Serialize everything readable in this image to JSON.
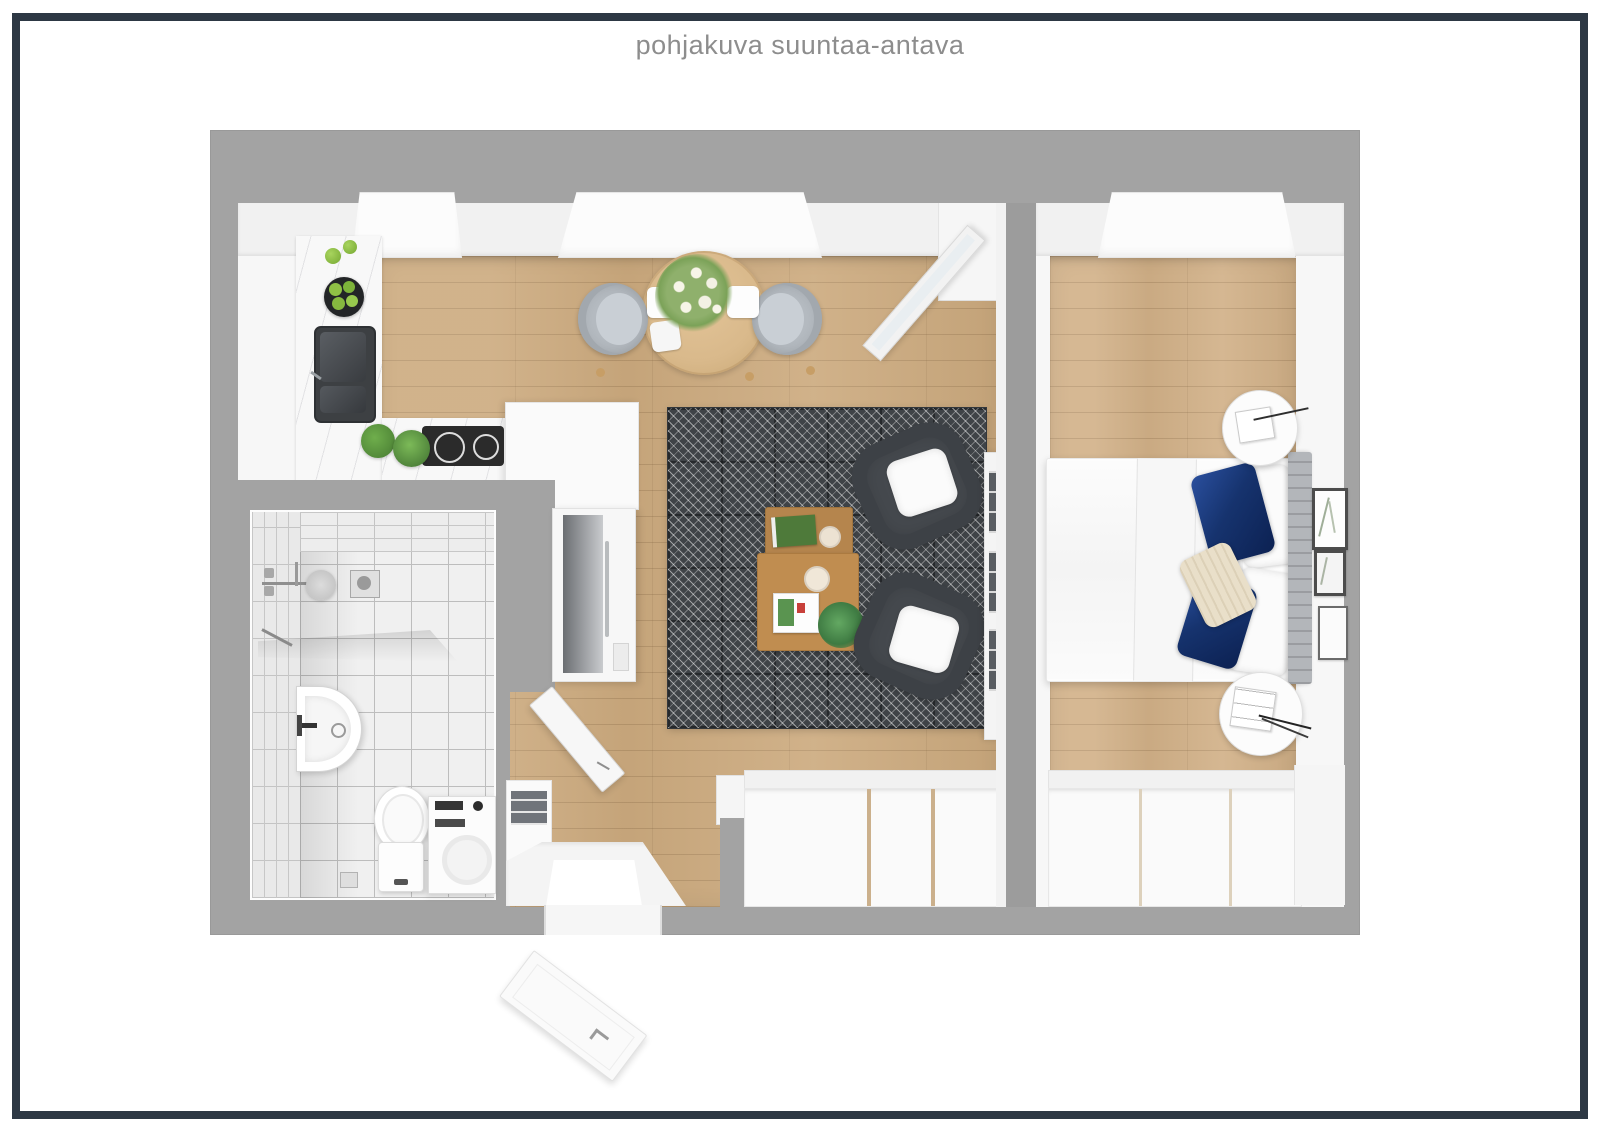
{
  "page": {
    "title": "pohjakuva suuntaa-antava"
  },
  "palette": {
    "frame": "#2d3844",
    "page-bg": "#ffffff",
    "title-color": "#8d8d8d",
    "wall": "#a3a3a3",
    "wood": "#ccaa7e",
    "wood-bedroom": "#d1b087",
    "tile": "#f0f0f0",
    "tile-grout": "#bdbdbd",
    "rug": "#3f4347",
    "chair": "#45494e",
    "table-wood": "#b5854d",
    "dining-wood": "#d9b98b",
    "navy-pillow": "#16336e",
    "headboard": "#b3b6ba",
    "greenery": "#5a9444",
    "appliance-dark": "#2b2b2b"
  }
}
